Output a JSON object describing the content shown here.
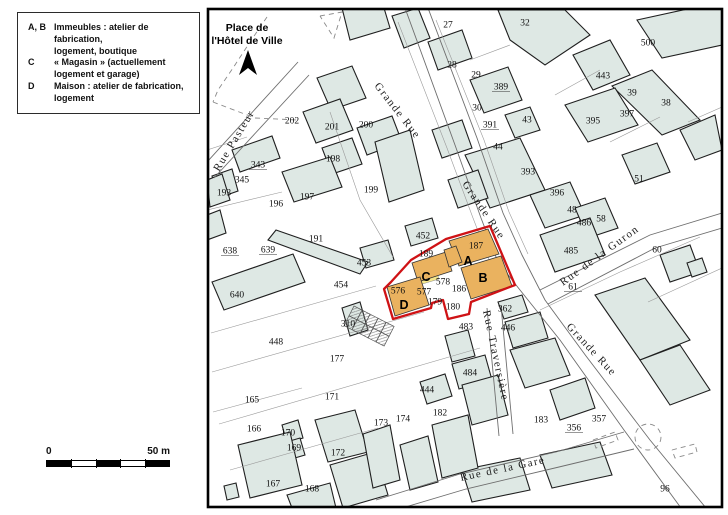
{
  "legend": {
    "items": [
      {
        "key": "A, B",
        "line1": "Immeubles : atelier de fabrication,",
        "line2": "logement, boutique"
      },
      {
        "key": "C",
        "line1": "« Magasin » (actuellement",
        "line2": "logement et garage)"
      },
      {
        "key": "D",
        "line1": "Maison : atelier de fabrication,",
        "line2": "logement"
      }
    ]
  },
  "scalebar": {
    "start": "0",
    "end": "50 m"
  },
  "colors": {
    "building_fill": "#dee8e4",
    "building_stroke": "#1f1f1f",
    "street_line": "#6e6e6e",
    "parcel_line": "#9a9a9a",
    "dashed_line": "#8a8a8a",
    "highlight_fill": "#eab25f",
    "highlight_stroke": "#cf1215",
    "yellow_strip": "#f5e68c",
    "map_border": "#000000"
  },
  "map": {
    "place_label": {
      "line1": "Place de",
      "line2": "l'Hôtel de Ville"
    },
    "north_arrow": "248,50 239,75 248,68 257,75",
    "border": {
      "x": 208,
      "y": 9,
      "w": 514,
      "h": 498
    },
    "streets": [
      {
        "name": "Grande Rue",
        "x": 374,
        "y": 86,
        "angle": 52,
        "ls": 1.5
      },
      {
        "name": "Grande Rue",
        "x": 462,
        "y": 184,
        "angle": 56,
        "ls": 1.5
      },
      {
        "name": "Grande Rue",
        "x": 566,
        "y": 327,
        "angle": 47,
        "ls": 1.5
      },
      {
        "name": "Rue de la Guron",
        "x": 563,
        "y": 286,
        "angle": -36,
        "ls": 0.8
      },
      {
        "name": "Rue Traversière",
        "x": 483,
        "y": 311,
        "angle": 78,
        "ls": 0.5
      },
      {
        "name": "Rue Pasteur",
        "x": 219,
        "y": 172,
        "angle": -59,
        "ls": 0.5
      },
      {
        "name": "Rue de la Gare",
        "x": 461,
        "y": 481,
        "angle": -12,
        "ls": 2
      }
    ],
    "highlight_letters": [
      {
        "t": "A",
        "x": 468,
        "y": 261
      },
      {
        "t": "B",
        "x": 483,
        "y": 278
      },
      {
        "t": "C",
        "x": 426,
        "y": 277
      },
      {
        "t": "D",
        "x": 404,
        "y": 305
      }
    ],
    "highlight": {
      "parcels": [
        "449,241 488,229 499,254 459,266",
        "461,268 501,256 512,286 471,299",
        "412,263 446,252 452,271 418,282",
        "444,250 456,246 462,262 449,267",
        "387,287 420,277 429,305 395,316"
      ],
      "yellow": "407,282 437,273 439,279 409,288",
      "outline": "446,239 490,226 515,285 471,302 469,314 448,319 443,300 432,303 431,308 393,319 384,289 391,282 411,260"
    },
    "parcels": [
      {
        "num": "202",
        "x": 292,
        "y": 120
      },
      {
        "num": "201",
        "x": 332,
        "y": 126
      },
      {
        "num": "200",
        "x": 366,
        "y": 124
      },
      {
        "num": "198",
        "x": 333,
        "y": 158
      },
      {
        "num": "343",
        "x": 258,
        "y": 164,
        "ul": true
      },
      {
        "num": "345",
        "x": 242,
        "y": 179
      },
      {
        "num": "193",
        "x": 224,
        "y": 192
      },
      {
        "num": "196",
        "x": 276,
        "y": 203
      },
      {
        "num": "197",
        "x": 307,
        "y": 196
      },
      {
        "num": "199",
        "x": 371,
        "y": 189
      },
      {
        "num": "191",
        "x": 316,
        "y": 238
      },
      {
        "num": "638",
        "x": 230,
        "y": 250,
        "ul": true
      },
      {
        "num": "639",
        "x": 268,
        "y": 249,
        "ul": true
      },
      {
        "num": "27",
        "x": 448,
        "y": 24
      },
      {
        "num": "32",
        "x": 525,
        "y": 22
      },
      {
        "num": "28",
        "x": 452,
        "y": 64
      },
      {
        "num": "29",
        "x": 476,
        "y": 74
      },
      {
        "num": "389",
        "x": 501,
        "y": 86,
        "ul": true
      },
      {
        "num": "30",
        "x": 477,
        "y": 107
      },
      {
        "num": "391",
        "x": 490,
        "y": 124,
        "ul": true
      },
      {
        "num": "43",
        "x": 527,
        "y": 119
      },
      {
        "num": "500",
        "x": 648,
        "y": 42
      },
      {
        "num": "443",
        "x": 603,
        "y": 75
      },
      {
        "num": "39",
        "x": 632,
        "y": 92
      },
      {
        "num": "38",
        "x": 666,
        "y": 102
      },
      {
        "num": "397",
        "x": 627,
        "y": 113
      },
      {
        "num": "395",
        "x": 593,
        "y": 120
      },
      {
        "num": "44",
        "x": 498,
        "y": 146
      },
      {
        "num": "393",
        "x": 528,
        "y": 171
      },
      {
        "num": "396",
        "x": 557,
        "y": 192
      },
      {
        "num": "51",
        "x": 639,
        "y": 178
      },
      {
        "num": "48",
        "x": 572,
        "y": 209
      },
      {
        "num": "486",
        "x": 584,
        "y": 222
      },
      {
        "num": "58",
        "x": 601,
        "y": 218
      },
      {
        "num": "485",
        "x": 571,
        "y": 250
      },
      {
        "num": "60",
        "x": 657,
        "y": 249
      },
      {
        "num": "61",
        "x": 573,
        "y": 286,
        "ul": true
      },
      {
        "num": "452",
        "x": 423,
        "y": 235
      },
      {
        "num": "189",
        "x": 426,
        "y": 253
      },
      {
        "num": "453",
        "x": 364,
        "y": 262
      },
      {
        "num": "187",
        "x": 476,
        "y": 245
      },
      {
        "num": "576",
        "x": 398,
        "y": 290
      },
      {
        "num": "577",
        "x": 424,
        "y": 291
      },
      {
        "num": "578",
        "x": 443,
        "y": 281
      },
      {
        "num": "186",
        "x": 459,
        "y": 288
      },
      {
        "num": "179",
        "x": 435,
        "y": 301
      },
      {
        "num": "180",
        "x": 453,
        "y": 306
      },
      {
        "num": "454",
        "x": 341,
        "y": 284
      },
      {
        "num": "310",
        "x": 348,
        "y": 323
      },
      {
        "num": "640",
        "x": 237,
        "y": 294
      },
      {
        "num": "448",
        "x": 276,
        "y": 341
      },
      {
        "num": "177",
        "x": 337,
        "y": 358
      },
      {
        "num": "483",
        "x": 466,
        "y": 326
      },
      {
        "num": "484",
        "x": 470,
        "y": 372
      },
      {
        "num": "446",
        "x": 508,
        "y": 327
      },
      {
        "num": "362",
        "x": 505,
        "y": 308
      },
      {
        "num": "165",
        "x": 252,
        "y": 399
      },
      {
        "num": "171",
        "x": 332,
        "y": 396
      },
      {
        "num": "166",
        "x": 254,
        "y": 428
      },
      {
        "num": "170",
        "x": 288,
        "y": 432
      },
      {
        "num": "169",
        "x": 294,
        "y": 447
      },
      {
        "num": "172",
        "x": 338,
        "y": 452
      },
      {
        "num": "173",
        "x": 381,
        "y": 422
      },
      {
        "num": "174",
        "x": 403,
        "y": 418
      },
      {
        "num": "444",
        "x": 427,
        "y": 389
      },
      {
        "num": "182",
        "x": 440,
        "y": 412
      },
      {
        "num": "167",
        "x": 273,
        "y": 483
      },
      {
        "num": "168",
        "x": 312,
        "y": 488
      },
      {
        "num": "183",
        "x": 541,
        "y": 419
      },
      {
        "num": "356",
        "x": 574,
        "y": 427,
        "ul": true
      },
      {
        "num": "357",
        "x": 599,
        "y": 418
      },
      {
        "num": "96",
        "x": 665,
        "y": 488
      }
    ],
    "buildings": [
      "342,8 384,8 390,28 350,40",
      "317,78 352,66 366,98 331,110",
      "303,112 340,99 353,130 316,143",
      "357,128 392,116 402,142 367,155",
      "322,148 352,138 362,164 332,174",
      "232,150 272,136 280,158 240,172",
      "212,176 232,169 238,191 218,198",
      "282,172 330,157 342,187 294,202",
      "375,142 410,130 424,190 389,202",
      "392,16 418,8 430,38 404,48",
      "428,42 462,30 472,58 438,70",
      "498,10 565,10 590,35 545,65 510,40",
      "470,80 508,67 522,100 484,113",
      "573,55 610,40 630,75 593,90",
      "637,20 692,8 722,8 722,45 662,58",
      "612,86 652,70 700,120 662,135",
      "680,130 715,115 722,150 695,160",
      "565,105 615,88 638,125 588,142",
      "505,115 530,107 540,130 515,138",
      "465,155 520,138 545,190 490,208",
      "530,195 570,182 585,215 545,228",
      "575,208 605,198 618,228 588,238",
      "622,155 657,143 670,172 635,184",
      "540,235 590,218 605,255 555,272",
      "660,255 690,245 700,272 670,282",
      "687,263 702,258 707,272 692,277",
      "595,295 645,278 690,340 640,360",
      "640,360 680,345 710,390 670,405",
      "462,470 520,458 530,490 472,502",
      "540,455 600,442 612,475 552,488",
      "498,302 522,295 528,312 504,319",
      "505,322 540,312 548,338 513,348",
      "510,350 555,338 570,375 525,388",
      "445,336 468,330 475,356 452,362",
      "452,364 485,355 492,380 459,389",
      "315,420 355,410 368,452 328,462",
      "330,465 375,452 388,495 343,508",
      "363,434 390,425 400,480 373,488",
      "400,445 428,436 438,482 410,490",
      "432,425 468,415 478,468 442,478",
      "282,425 298,420 303,438 287,443",
      "283,443 300,438 305,455 288,460",
      "238,445 290,432 302,485 250,498",
      "287,495 330,483 336,508 292,508",
      "462,385 498,375 508,415 472,425",
      "550,390 585,378 595,408 560,420",
      "212,282 293,254 305,282 224,310",
      "342,308 360,302 368,330 350,336",
      "207,180 222,174 230,200 210,207",
      "207,215 220,210 226,233 207,240",
      "224,486 236,483 239,497 227,500",
      "405,226 432,218 438,238 411,246",
      "360,248 388,240 394,260 366,268",
      "268,240 276,230 368,262 360,274",
      "432,130 462,120 472,148 442,158",
      "448,180 478,170 488,198 458,208",
      "420,382 445,374 452,396 427,404"
    ],
    "street_lines": [
      "405,8 455,145 481,218 498,262 520,290 560,340 624,430 681,508",
      "428,8 477,138 503,213 522,255 545,300 586,356 650,440 706,508",
      "540,290 650,235 722,213",
      "548,304 655,248 722,228",
      "487,308 499,436",
      "501,306 513,434",
      "376,500 460,474 556,452 624,432",
      "382,514 466,489 559,467 634,449",
      "298,62 207,162",
      "309,75 214,178"
    ],
    "parcel_lines": [
      "330,112 360,200 393,257",
      "207,210 282,192",
      "247,137 207,150",
      "212,372 424,312",
      "219,424 480,348",
      "230,470 378,428",
      "213,412 302,388",
      "470,60 510,45",
      "555,95 600,70",
      "610,142 660,117",
      "688,122 722,107",
      "540,310 620,272 700,237",
      "376,286 211,333",
      "648,302 722,268",
      "398,22 447,148 473,218 490,262",
      "436,20 484,140 509,212 528,254"
    ],
    "dashed_lines": [
      "267,17 250,42 233,68 218,90 213,102",
      "213,102 255,118 298,120",
      "320,16 342,12 334,38 320,16",
      "593,440 615,432 618,440 596,448 593,440",
      "672,450 695,444 697,452 675,458 672,450"
    ],
    "dashed_circle": {
      "cx": 648,
      "cy": 437,
      "r": 13
    },
    "sheds": {
      "x": 354,
      "y": 306,
      "angle": 27,
      "cols": 5,
      "rows": 2,
      "cw": 9,
      "ch": 11
    }
  }
}
